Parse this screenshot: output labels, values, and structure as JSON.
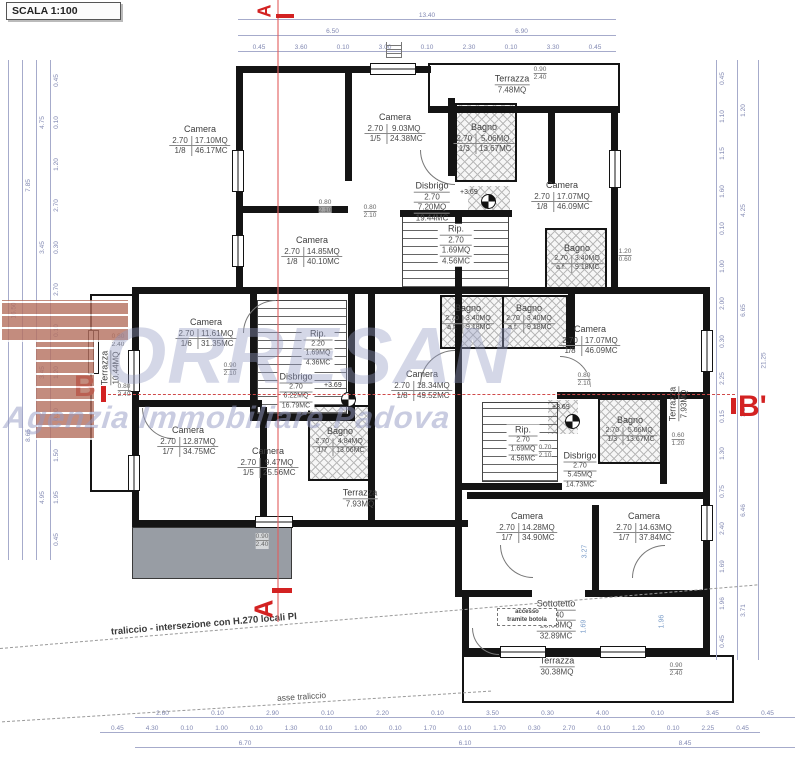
{
  "scale_label": "SCALA 1:100",
  "watermark": {
    "word": "ORRESAN",
    "subtitle": "Agenzia Immobiliare Padova"
  },
  "sections": {
    "a_top": "A",
    "a_bottom": "A",
    "b_left": "B",
    "b_right": "B'"
  },
  "notes": {
    "traliccio": "traliccio - intersezione con H.270 locali PI",
    "asse": "asse traliccio",
    "level": "+3.69",
    "botola_1": "accesso",
    "botola_2": "tramite botola"
  },
  "colors": {
    "wall": "#141414",
    "dim": "#8188b2",
    "section_red": "#d32222",
    "watermark_blue": "#949ac3"
  },
  "rooms": [
    {
      "name": "Camera",
      "h": "2.70",
      "r": "1/8",
      "mq": "17.10MQ",
      "mc": "46.17MC"
    },
    {
      "name": "Camera",
      "h": "2.70",
      "r": "1/5",
      "mq": "9.03MQ",
      "mc": "24.38MC"
    },
    {
      "name": "Terrazza",
      "mq": "7.48MQ"
    },
    {
      "name": "Bagno",
      "h": "2.70",
      "r": "1/3",
      "mq": "5.06MQ",
      "mc": "13.67MC"
    },
    {
      "name": "Camera",
      "h": "2.70",
      "r": "1/8",
      "mq": "17.07MQ",
      "mc": "46.09MC"
    },
    {
      "name": "Disbrigo",
      "h": "2.70",
      "mq": "7.20MQ",
      "mc": "19.44MC"
    },
    {
      "name": "Rip.",
      "h": "2.70",
      "mq": "1.69MQ",
      "mc": "4.56MC"
    },
    {
      "name": "Camera",
      "h": "2.70",
      "r": "1/8",
      "mq": "14.85MQ",
      "mc": "40.10MC"
    },
    {
      "name": "Bagno",
      "h": "2.70",
      "r": "a.f.",
      "mq": "3.40MQ",
      "mc": "9.18MC"
    },
    {
      "name": "Bagno",
      "h": "2.70",
      "r": "a.f.",
      "mq": "3.40MQ",
      "mc": "9.18MC"
    },
    {
      "name": "Bagno",
      "h": "2.70",
      "r": "a.f.",
      "mq": "3.40MQ",
      "mc": "9.18MC"
    },
    {
      "name": "Terrazza",
      "mq": "10.44MQ"
    },
    {
      "name": "Camera",
      "h": "2.70",
      "r": "1/6",
      "mq": "11.61MQ",
      "mc": "31.35MC"
    },
    {
      "name": "Rip.",
      "h": "2.20",
      "mq": "1.69MQ",
      "mc": "4.36MC"
    },
    {
      "name": "Disbrigo",
      "h": "2.70",
      "mq": "6.22MQ",
      "mc": "16.79MC"
    },
    {
      "name": "Camera",
      "h": "2.70",
      "r": "1/8",
      "mq": "18.34MQ",
      "mc": "49.52MC"
    },
    {
      "name": "Camera",
      "h": "2.70",
      "r": "1/8",
      "mq": "17.07MQ",
      "mc": "46.09MC"
    },
    {
      "name": "Rip.",
      "h": "2.70",
      "mq": "1.69MQ",
      "mc": "4.56MC"
    },
    {
      "name": "Disbrigo",
      "h": "2.70",
      "mq": "5.45MQ",
      "mc": "14.73MC"
    },
    {
      "name": "Bagno",
      "h": "2.70",
      "r": "1/7",
      "mq": "4.84MQ",
      "mc": "13.06MC"
    },
    {
      "name": "Camera",
      "h": "2.70",
      "r": "1/7",
      "mq": "12.87MQ",
      "mc": "34.75MC"
    },
    {
      "name": "Camera",
      "h": "2.70",
      "r": "1/5",
      "mq": "9.47MQ",
      "mc": "25.56MC"
    },
    {
      "name": "Bagno",
      "h": "2.70",
      "r": "1/3",
      "mq": "5.06MQ",
      "mc": "13.67MC"
    },
    {
      "name": "Terrazza",
      "mq": "7.93MQ"
    },
    {
      "name": "Terrazza",
      "mq": "7.93MQ"
    },
    {
      "name": "Camera",
      "h": "2.70",
      "r": "1/7",
      "mq": "14.28MQ",
      "mc": "34.90MC"
    },
    {
      "name": "Camera",
      "h": "2.70",
      "r": "1/7",
      "mq": "14.63MQ",
      "mc": "37.84MC"
    },
    {
      "name": "Sottotetto",
      "h": "2.40",
      "mq": "13.68MQ",
      "mc": "32.89MC"
    },
    {
      "name": "Terrazza",
      "mq": "30.38MQ"
    }
  ],
  "doors": [
    {
      "w": "0.80",
      "h": "2.10"
    },
    {
      "w": "0.90",
      "h": "2.40"
    },
    {
      "w": "0.80",
      "h": "2.40"
    },
    {
      "w": "0.80",
      "h": "2.40"
    },
    {
      "w": "0.90",
      "h": "2.10"
    },
    {
      "w": "0.80",
      "h": "2.10"
    },
    {
      "w": "0.70",
      "h": "2.10"
    },
    {
      "w": "0.60",
      "h": "1.20"
    },
    {
      "w": "1.20",
      "h": "0.60"
    },
    {
      "w": "0.90",
      "h": "2.40"
    },
    {
      "w": "0.90",
      "h": "2.40"
    },
    {
      "w": "0.80",
      "h": "2.10"
    }
  ],
  "dims": {
    "top_total": [
      "13.40"
    ],
    "top_sub": [
      "6.50",
      "6.90"
    ],
    "top_detail": [
      "0.45",
      "3.60",
      "0.10",
      "3.00",
      "0.10",
      "2.30",
      "0.10",
      "3.30",
      "0.45"
    ],
    "bottom_r1": [
      "2.60",
      "0.10",
      "2.90",
      "0.10",
      "2.20",
      "0.10",
      "3.50",
      "0.30",
      "4.00",
      "0.10",
      "3.45",
      "0.45"
    ],
    "bottom_r2": [
      "0.45",
      "4.30",
      "0.10",
      "1.00",
      "0.10",
      "1.30",
      "0.10",
      "1.00",
      "0.10",
      "1.70",
      "0.10",
      "1.70",
      "0.30",
      "2.70",
      "0.10",
      "1.20",
      "0.10",
      "2.25",
      "0.45"
    ],
    "bottom_r3": [
      "6.70",
      "6.10",
      "8.45"
    ],
    "left_c1": [
      "16.50"
    ],
    "left_c2": [
      "7.85",
      "8.65"
    ],
    "left_c3": [
      "4.75",
      "3.45",
      "3.45",
      "4.95"
    ],
    "left_c4": [
      "0.45",
      "0.10",
      "1.20",
      "2.70",
      "0.30",
      "2.70",
      "0.10",
      "1.20",
      "0.10",
      "1.50",
      "1.95",
      "0.45"
    ],
    "right_c1": [
      "21.25"
    ],
    "right_c2": [
      "1.20",
      "4.25",
      "6.65",
      "3.30",
      "6.46",
      "3.71"
    ],
    "right_c3": [
      "0.45",
      "1.10",
      "1.15",
      "1.60",
      "0.10",
      "1.00",
      "2.00",
      "0.30",
      "2.25",
      "0.15",
      "1.30",
      "0.75",
      "2.40",
      "1.69",
      "1.96",
      "0.45"
    ],
    "inner": [
      "3.27",
      "1.69",
      "1.96"
    ]
  }
}
